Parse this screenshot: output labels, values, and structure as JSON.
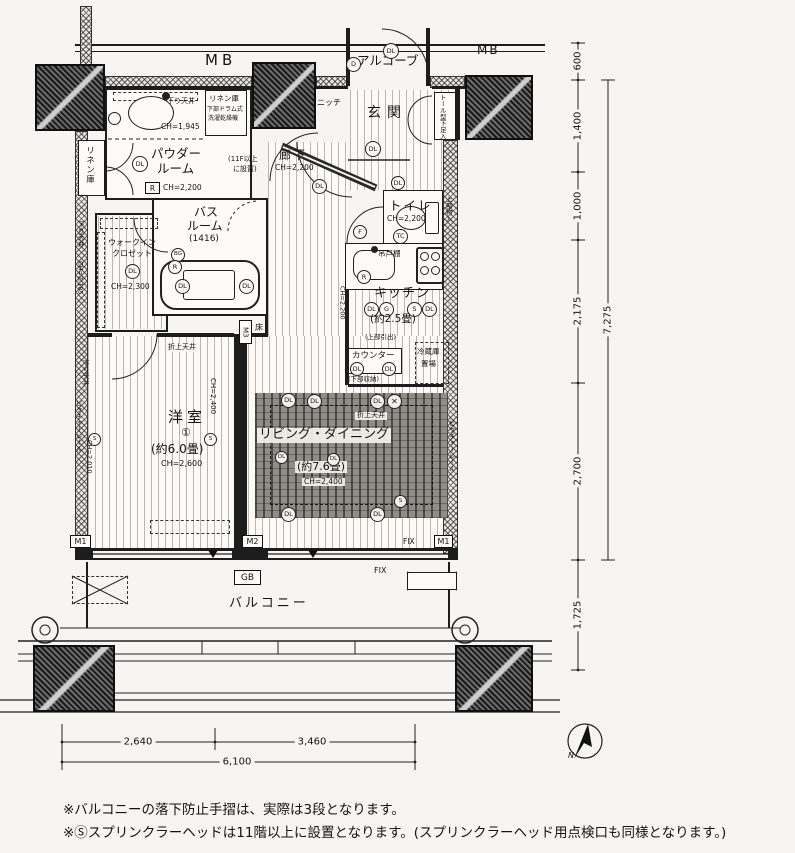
{
  "labels": {
    "mb": "MB",
    "alcove": "アルコーブ",
    "genkan": "玄関",
    "hall": "廊下",
    "toilet": "トイレ",
    "powder_l1": "パウダー",
    "powder_l2": "ルーム",
    "bath_l1": "バス",
    "bath_l2": "ルーム",
    "bath_size": "(1416)",
    "linen": "リネン庫",
    "linen_top_l1": "リネン庫",
    "linen_top_l2": "下部ドラム式",
    "linen_top_l3": "洗濯乾燥機",
    "wic_l1": "ウォークイン",
    "wic_l2": "クロゼット",
    "kitchen": "キッチン",
    "kitchen_size": "(約2.5畳)",
    "western": "洋室",
    "western_num": "①",
    "western_size": "(約6.0畳)",
    "ld": "リビング・ダイニング",
    "ld_size": "(約7.6畳)",
    "balcony": "バルコニー",
    "tall_shoe": "トール型下足入",
    "niche": "ニッチ",
    "upper_storage": "上部物入",
    "hanging_cupboard": "吊戸棚",
    "counter": "カウンター",
    "upper_drawer": "(上部引出)",
    "lower_storage": "(下部収納)",
    "fridge_l1": "冷蔵庫",
    "fridge_l2": "置場",
    "sprinkler_box_l1": "(11F以上",
    "sprinkler_box_l2": "に設置)",
    "drop_ceiling": "下り天井",
    "coffered_ceiling": "折上天井",
    "picture_rail": "ピクチャーレール",
    "floor": "床"
  },
  "ceiling_heights": {
    "ch2200": "CH=2,200",
    "ch1945": "CH=1,945",
    "ch2300": "CH=2,300",
    "ch2185": "CH=2,185",
    "ch2400": "CH=2,400",
    "ch2600": "CH=2,600",
    "ch2010": "CH=2,010"
  },
  "symbols": {
    "dl": "DL",
    "d": "D",
    "r": "R",
    "f": "F",
    "tc": "TC",
    "bg": "BG",
    "g": "G",
    "s": "S",
    "x": "✕",
    "m1": "M1",
    "m2": "M2",
    "m3": "M3",
    "gb": "GB",
    "fix": "FIX",
    "north": "N"
  },
  "dimensions": {
    "right": [
      "600",
      "1,400",
      "1,000",
      "2,175",
      "2,700",
      "1,725"
    ],
    "right_total": "7,275",
    "bottom": [
      "2,640",
      "3,460"
    ],
    "bottom_total": "6,100"
  },
  "notes": [
    "※バルコニーの落下防止手摺は、実際は3段となります。",
    "※Ⓢスプリンクラーヘッドは11階以上に設置となります。(スプリンクラーヘッド用点検口も同様となります。)"
  ]
}
